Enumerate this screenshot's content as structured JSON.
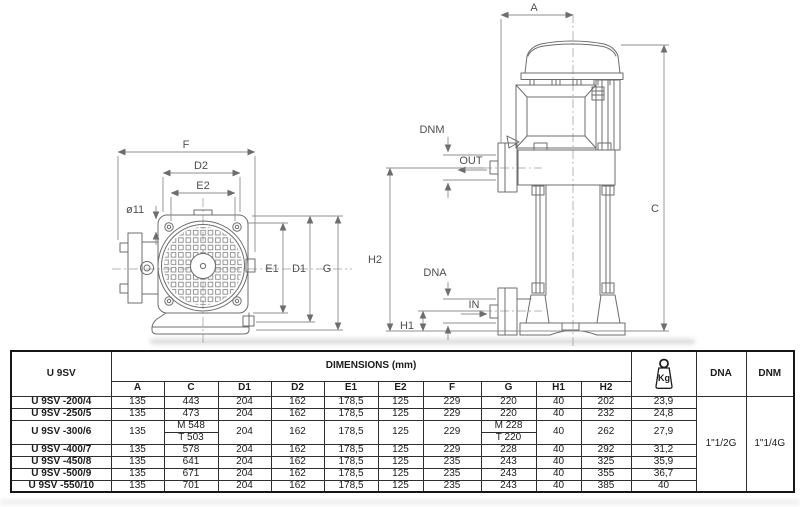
{
  "drawings": {
    "front_view": {
      "f": "F",
      "d2": "D2",
      "e2": "E2",
      "hole_diameter": "ø11",
      "e1": "E1",
      "d1": "D1",
      "g": "G"
    },
    "side_view": {
      "a": "A",
      "c": "C",
      "h1": "H1",
      "h2": "H2",
      "dnm": "DNM",
      "dna": "DNA",
      "out": "OUT",
      "in": "IN"
    }
  },
  "table": {
    "series_label": "U 9SV",
    "dimensions_header": "DIMENSIONS (mm)",
    "columns": [
      "A",
      "C",
      "D1",
      "D2",
      "E1",
      "E2",
      "F",
      "G",
      "H1",
      "H2"
    ],
    "kg_label": "Kg",
    "dna_header": "DNA",
    "dnm_header": "DNM",
    "dna_value": "1\"1/2G",
    "dnm_value": "1\"1/4G",
    "rows": [
      {
        "model": "U 9SV -200/4",
        "a": "135",
        "c": "443",
        "d1": "204",
        "d2": "162",
        "e1": "178,5",
        "e2": "125",
        "f": "229",
        "g": "220",
        "h1": "40",
        "h2": "202",
        "kg": "23,9"
      },
      {
        "model": "U 9SV -250/5",
        "a": "135",
        "c": "473",
        "d1": "204",
        "d2": "162",
        "e1": "178,5",
        "e2": "125",
        "f": "229",
        "g": "220",
        "h1": "40",
        "h2": "232",
        "kg": "24,8"
      },
      {
        "model": "U 9SV -300/6",
        "a": "135",
        "c_motor": "M 548",
        "c_alt": "T 503",
        "d1": "204",
        "d2": "162",
        "e1": "178,5",
        "e2": "125",
        "f": "229",
        "g_motor": "M 228",
        "g_alt": "T 220",
        "h1": "40",
        "h2": "262",
        "kg": "27,9"
      },
      {
        "model": "U 9SV -400/7",
        "a": "135",
        "c": "578",
        "d1": "204",
        "d2": "162",
        "e1": "178,5",
        "e2": "125",
        "f": "229",
        "g": "228",
        "h1": "40",
        "h2": "292",
        "kg": "31,2"
      },
      {
        "model": "U 9SV -450/8",
        "a": "135",
        "c": "641",
        "d1": "204",
        "d2": "162",
        "e1": "178,5",
        "e2": "125",
        "f": "235",
        "g": "243",
        "h1": "40",
        "h2": "325",
        "kg": "35,9"
      },
      {
        "model": "U 9SV -500/9",
        "a": "135",
        "c": "671",
        "d1": "204",
        "d2": "162",
        "e1": "178,5",
        "e2": "125",
        "f": "235",
        "g": "243",
        "h1": "40",
        "h2": "355",
        "kg": "36,7"
      },
      {
        "model": "U 9SV -550/10",
        "a": "135",
        "c": "701",
        "d1": "204",
        "d2": "162",
        "e1": "178,5",
        "e2": "125",
        "f": "235",
        "g": "243",
        "h1": "40",
        "h2": "385",
        "kg": "40"
      }
    ]
  }
}
